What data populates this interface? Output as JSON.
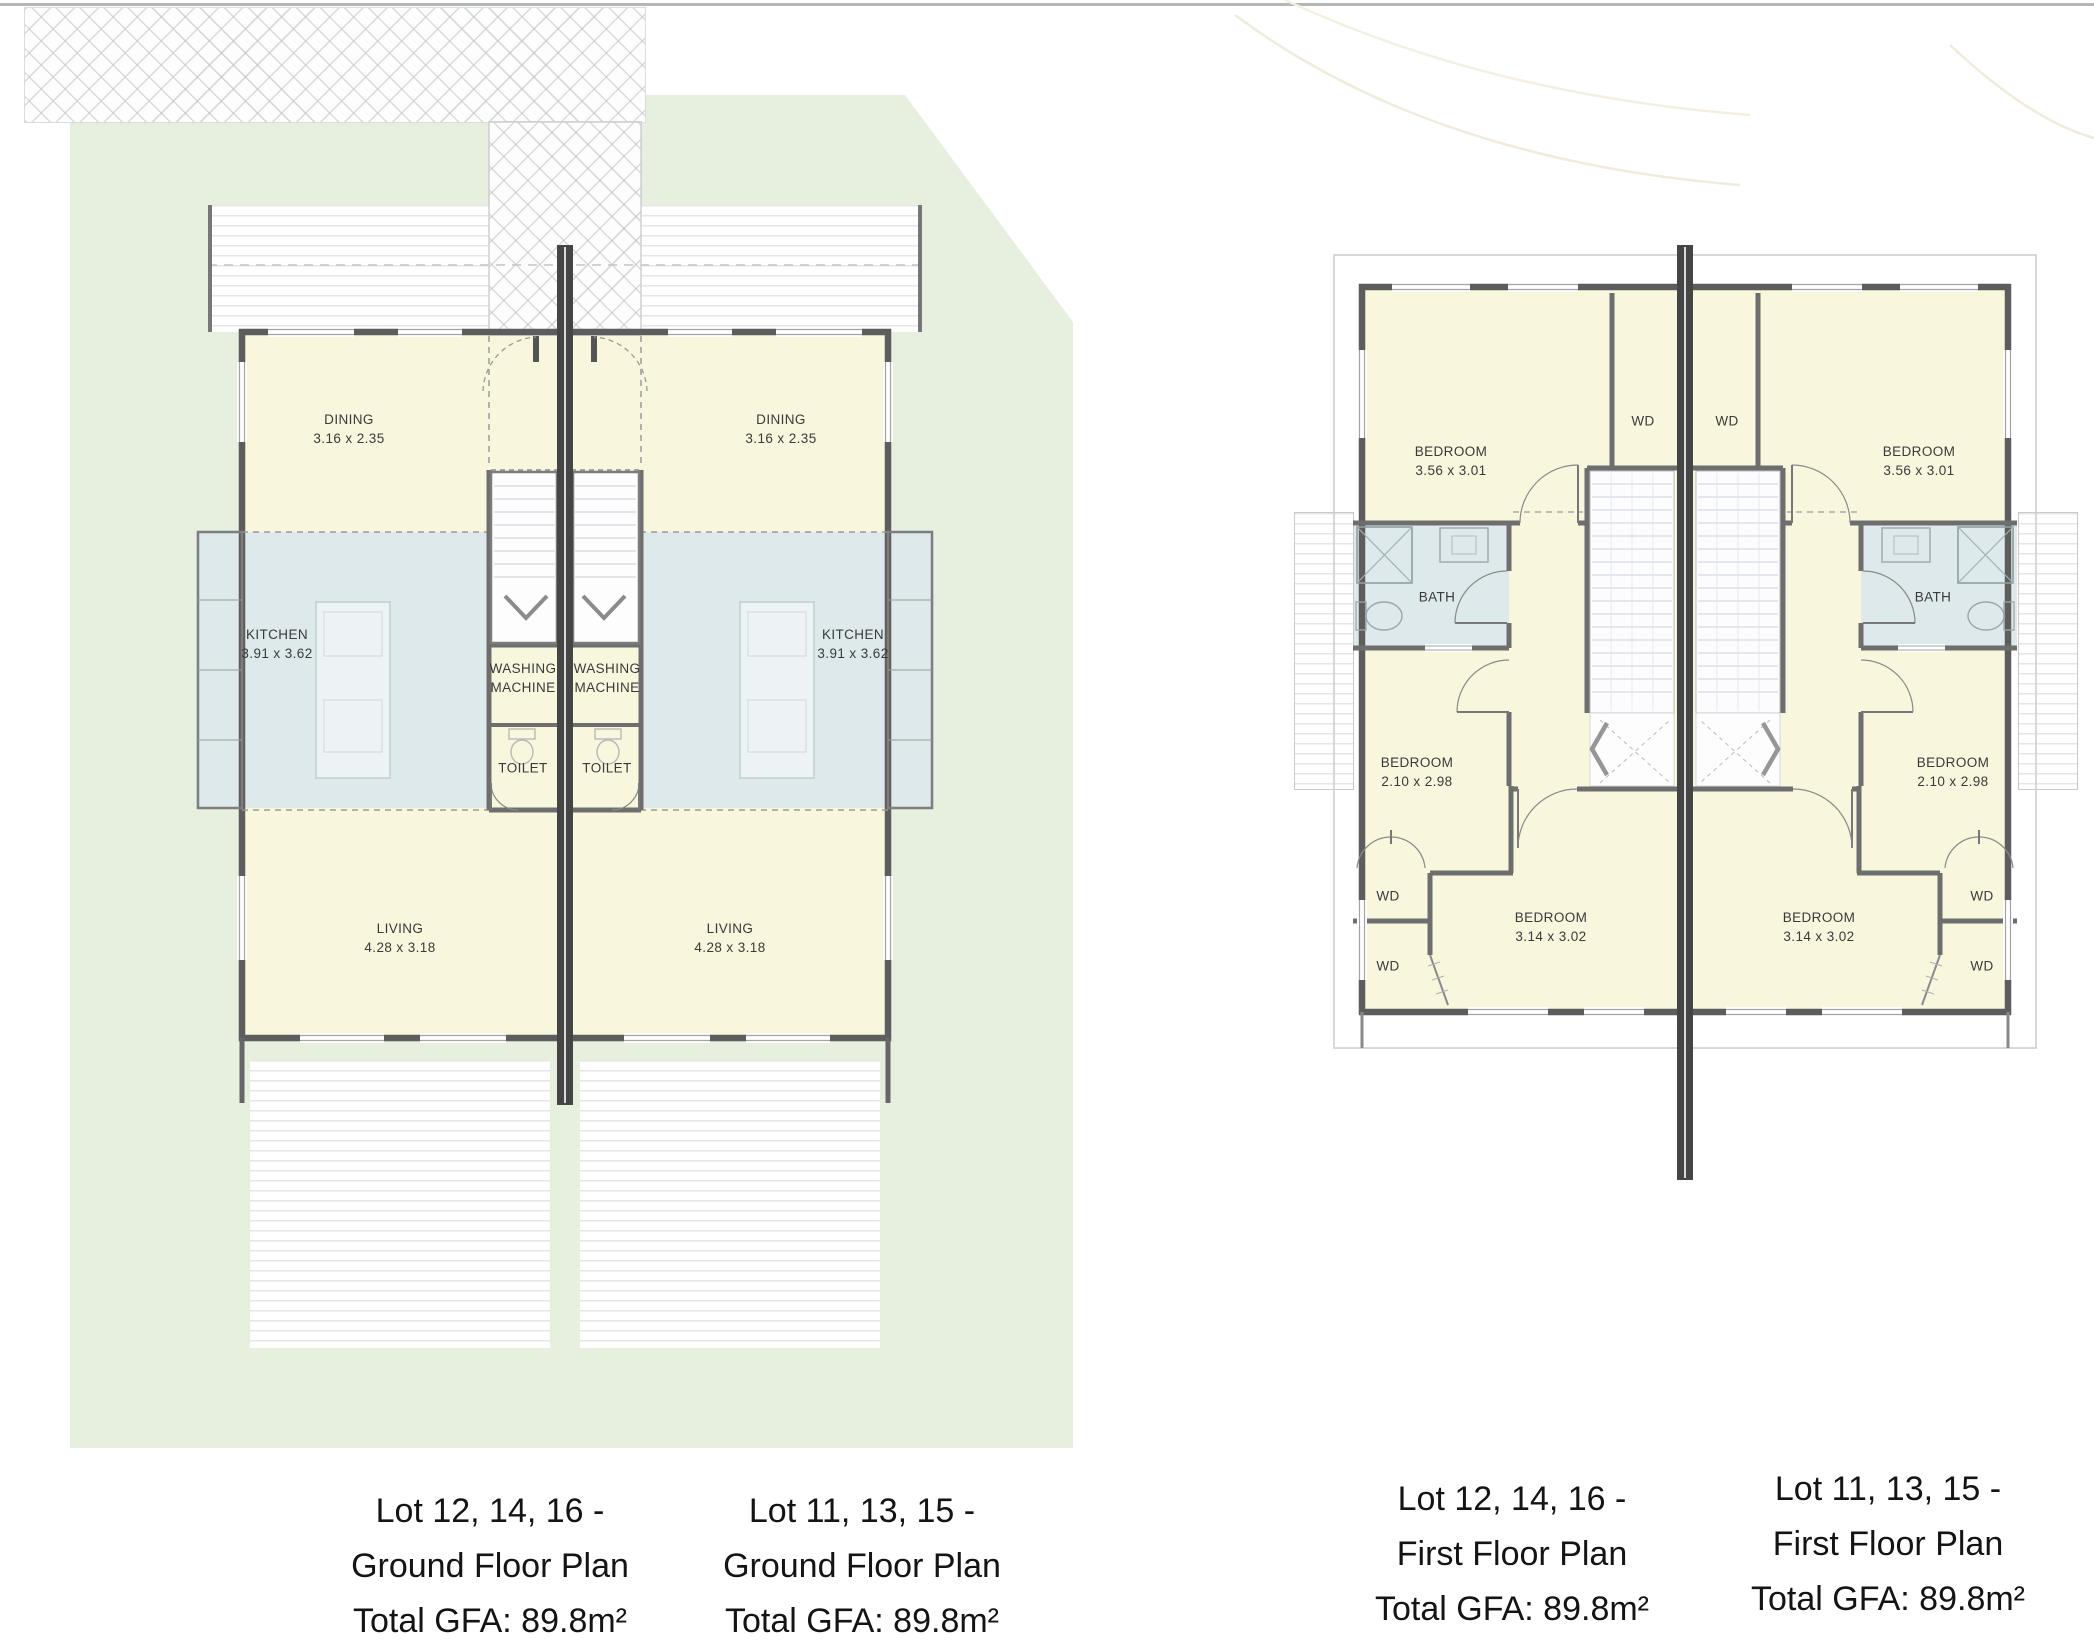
{
  "ground_floor": {
    "caption_left": {
      "line1": "Lot 12, 14, 16 -",
      "line2": "Ground Floor Plan",
      "line3": "Total GFA: 89.8m²"
    },
    "caption_right": {
      "line1": "Lot 11, 13, 15 -",
      "line2": "Ground Floor Plan",
      "line3": "Total GFA: 89.8m²"
    },
    "unit_left": {
      "dining": {
        "name": "DINING",
        "dims": "3.16 x 2.35"
      },
      "kitchen": {
        "name": "KITCHEN",
        "dims": "3.91 x 3.62"
      },
      "washing": {
        "line1": "WASHING",
        "line2": "MACHINE"
      },
      "toilet": {
        "name": "TOILET"
      },
      "living": {
        "name": "LIVING",
        "dims": "4.28 x 3.18"
      }
    },
    "unit_right": {
      "dining": {
        "name": "DINING",
        "dims": "3.16 x 2.35"
      },
      "kitchen": {
        "name": "KITCHEN",
        "dims": "3.91 x 3.62"
      },
      "washing": {
        "line1": "WASHING",
        "line2": "MACHINE"
      },
      "toilet": {
        "name": "TOILET"
      },
      "living": {
        "name": "LIVING",
        "dims": "4.28 x 3.18"
      }
    }
  },
  "first_floor": {
    "caption_left": {
      "line1": "Lot 12, 14, 16 -",
      "line2": "First Floor Plan",
      "line3": "Total GFA: 89.8m²"
    },
    "caption_right": {
      "line1": "Lot 11, 13, 15 -",
      "line2": "First Floor Plan",
      "line3": "Total GFA: 89.8m²"
    },
    "unit_left": {
      "bedroom_top": {
        "name": "BEDROOM",
        "dims": "3.56 x 3.01"
      },
      "wd_top": "WD",
      "bath": "BATH",
      "bedroom_mid": {
        "name": "BEDROOM",
        "dims": "2.10 x 2.98"
      },
      "bedroom_bottom": {
        "name": "BEDROOM",
        "dims": "3.14 x 3.02"
      },
      "wd_upper": "WD",
      "wd_lower": "WD"
    },
    "unit_right": {
      "bedroom_top": {
        "name": "BEDROOM",
        "dims": "3.56 x 3.01"
      },
      "wd_top": "WD",
      "bath": "BATH",
      "bedroom_mid": {
        "name": "BEDROOM",
        "dims": "2.10 x 2.98"
      },
      "bedroom_bottom": {
        "name": "BEDROOM",
        "dims": "3.14 x 3.02"
      },
      "wd_upper": "WD",
      "wd_lower": "WD"
    }
  },
  "colors": {
    "site_green": "#e7efdf",
    "room_yellow": "#f8f6dd",
    "wet_area_blue": "#dde9ea",
    "wall_gray": "#5d5d5d",
    "party_wall": "#454545"
  }
}
